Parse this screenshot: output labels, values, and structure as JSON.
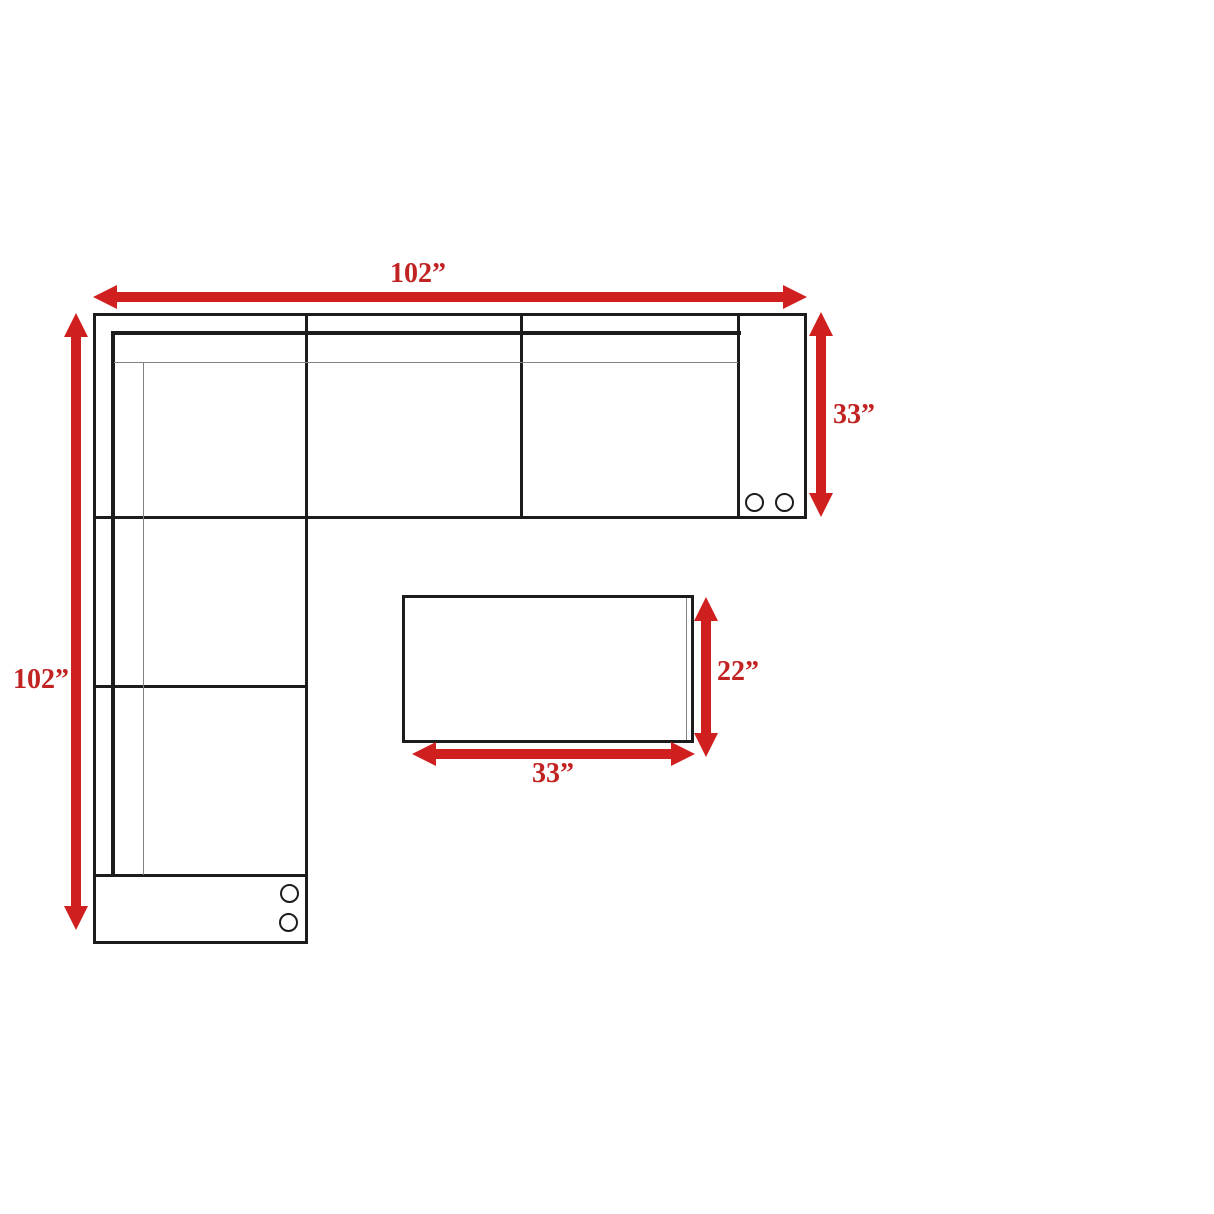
{
  "diagram": {
    "kind": "furniture-dimension-diagram-top-view",
    "dimensions": {
      "sofa_width": "102”",
      "sofa_length": "102”",
      "sofa_depth": "33”",
      "ottoman_depth": "22”",
      "ottoman_width": "33”"
    },
    "colors": {
      "arrow_red": "#d01f1f",
      "label_red": "#c12222",
      "line_black": "#1c1c1c",
      "thin_gray": "#828282",
      "background": "#ffffff"
    },
    "icons": {
      "cupholder": "circle-outline"
    }
  }
}
